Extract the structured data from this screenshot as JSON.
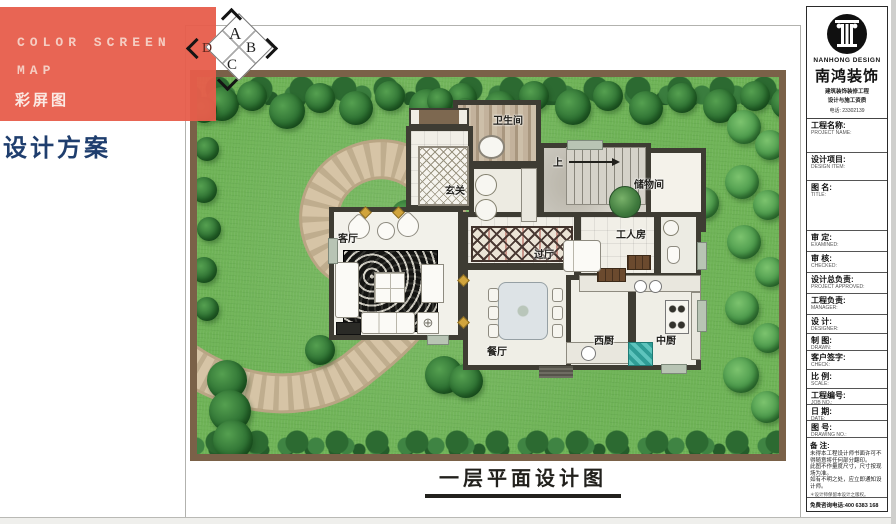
{
  "panel": {
    "line1": "COLOR SCREEN",
    "line2": "MAP",
    "line3": "彩屏图",
    "scheme": "设计方案",
    "box_color": "#e75d4b"
  },
  "compass": {
    "a": "A",
    "b": "B",
    "c": "C",
    "d": "D"
  },
  "plan": {
    "caption": "一层平面设计图",
    "rooms": {
      "bathroom": "卫生间",
      "foyer": "玄关",
      "storage": "储物间",
      "stairs_up": "上",
      "living": "客厅",
      "hallway": "过厅",
      "worker": "工人房",
      "dining": "餐厅",
      "west_kitchen": "西厨",
      "chinese_kitchen": "中厨"
    }
  },
  "titleblock": {
    "brand_en": "NANHONG DESIGN",
    "brand_cn": "南鸿装饰",
    "sub1": "建筑装饰装修工程",
    "sub2": "设计与施工资质",
    "tel": "电话: 23302139",
    "fields": [
      {
        "cn": "工程名称:",
        "en": "PROJECT NAME:"
      },
      {
        "cn": "设计项目:",
        "en": "DESIGN ITEM:"
      },
      {
        "cn": "图  名:",
        "en": "TITLE:"
      },
      {
        "cn": "审  定:",
        "en": "EXAMINED:"
      },
      {
        "cn": "审  核:",
        "en": "CHECKED:"
      },
      {
        "cn": "设计总负责:",
        "en": "PROJECT APPROVED:"
      },
      {
        "cn": "工程负责:",
        "en": "MANAGER:"
      },
      {
        "cn": "设  计:",
        "en": "DESIGNER:"
      },
      {
        "cn": "制  图:",
        "en": "DRAWN:"
      },
      {
        "cn": "客户签字:",
        "en": "CHECK:"
      },
      {
        "cn": "比  例:",
        "en": "SCALE:"
      },
      {
        "cn": "工程编号:",
        "en": "JOB NO.:"
      },
      {
        "cn": "日  期:",
        "en": "DATE:"
      },
      {
        "cn": "图  号:",
        "en": "DRAWING NO.:"
      }
    ],
    "notes_label": "备 注:",
    "notes": [
      "未得本工程设计师书面许可不得随意将任何部分翻印。",
      "此图不作量度尺寸，尺寸按现场为准。",
      "如有不明之处，应立即通知设计师。"
    ],
    "notes_small": "＊设计师保留本设计之版权。",
    "hotline": "免费咨询电话:400 6383 168"
  },
  "colors": {
    "lawn": "#6fb357",
    "path": "#d4c2a4",
    "wall": "#3e3c33",
    "accent_red": "#e75d4b",
    "navy": "#1f3e6e"
  }
}
